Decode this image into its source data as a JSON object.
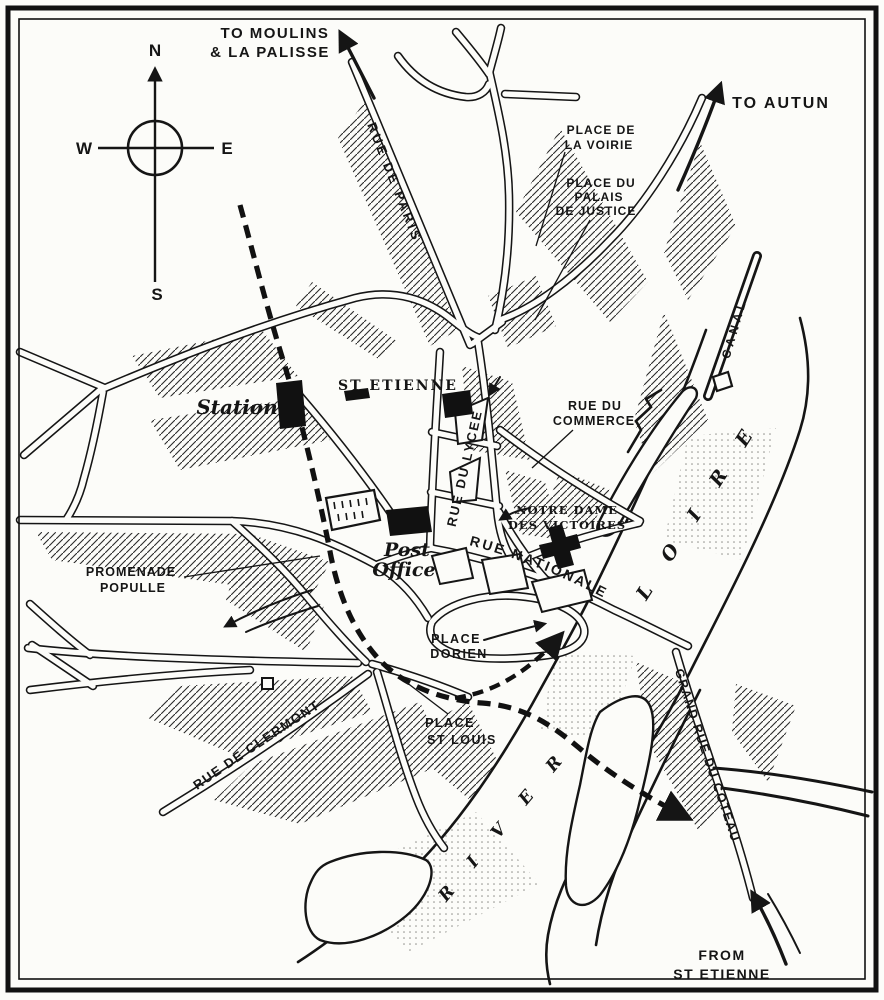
{
  "compass": {
    "n": "N",
    "e": "E",
    "s": "S",
    "w": "W"
  },
  "directions": {
    "to_moulins_1": "TO MOULINS",
    "to_moulins_2": "& LA PALISSE",
    "to_autun": "TO AUTUN",
    "from_st_etienne_1": "FROM",
    "from_st_etienne_2": "ST ETIENNE"
  },
  "streets": {
    "rue_de_paris": "RUE DE PARIS",
    "rue_du_lycee": "RUE DU LYCEE",
    "rue_du_commerce_1": "RUE DU",
    "rue_du_commerce_2": "COMMERCE",
    "rue_nationale": "RUE NATIONALE",
    "rue_de_clermont": "RUE DE CLERMONT",
    "grand_rue_du_coteau": "GRAND RUE DU COTEAU",
    "promenade_1": "PROMENADE",
    "promenade_2": "POPULLE"
  },
  "places": {
    "voirie_1": "PLACE DE",
    "voirie_2": "LA VOIRIE",
    "palais_1": "PLACE DU",
    "palais_2": "PALAIS",
    "palais_3": "DE JUSTICE",
    "dorien_1": "PLACE",
    "dorien_2": "DORIEN",
    "st_louis_1": "PLACE",
    "st_louis_2": "ST LOUIS"
  },
  "landmarks": {
    "station": "Station",
    "st_etienne_church": "ST ETIENNE",
    "post_office_1": "Post",
    "post_office_2": "Office",
    "notre_dame_1": "NOTRE DAME",
    "notre_dame_2": "DES VICTOIRES"
  },
  "water": {
    "canal": "CANAL",
    "loire": "LOIRE",
    "river": "RIVER"
  },
  "colors": {
    "ink": "#151515",
    "paper": "#fcfcf9"
  }
}
